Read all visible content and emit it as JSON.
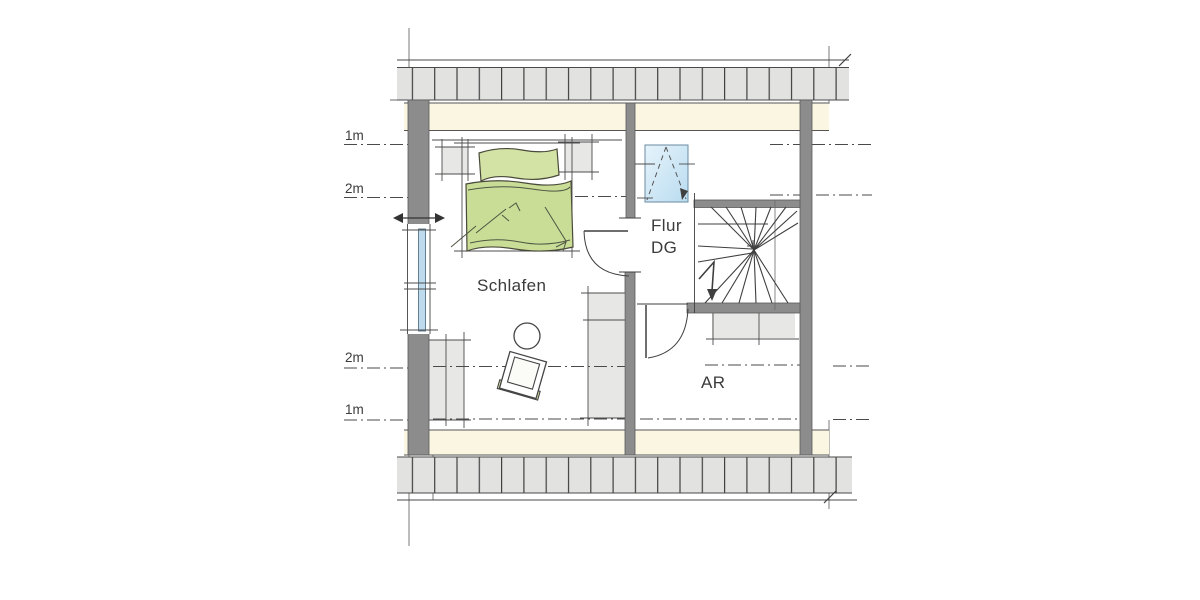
{
  "labels": {
    "bedroom": "Schlafen",
    "hall_line1": "Flur",
    "hall_line2": "DG",
    "storage": "AR"
  },
  "height_marks": {
    "top_outer": "1m",
    "top_inner": "2m",
    "bottom_inner": "2m",
    "bottom_outer": "1m"
  },
  "colors": {
    "wall_gray": "#8c8c8c",
    "hatch_gray": "#e2e2e1",
    "knee_band_cream": "#faf6e2",
    "furniture_gray": "#e7e7e6",
    "bed_green": "#c9dd97",
    "pillow_green": "#d3e3a5",
    "cushion_green": "#dbe5ae",
    "glazing_blue": "#bedbee",
    "skylight_blue": "#cfe7f6",
    "line_dark": "#444444"
  }
}
